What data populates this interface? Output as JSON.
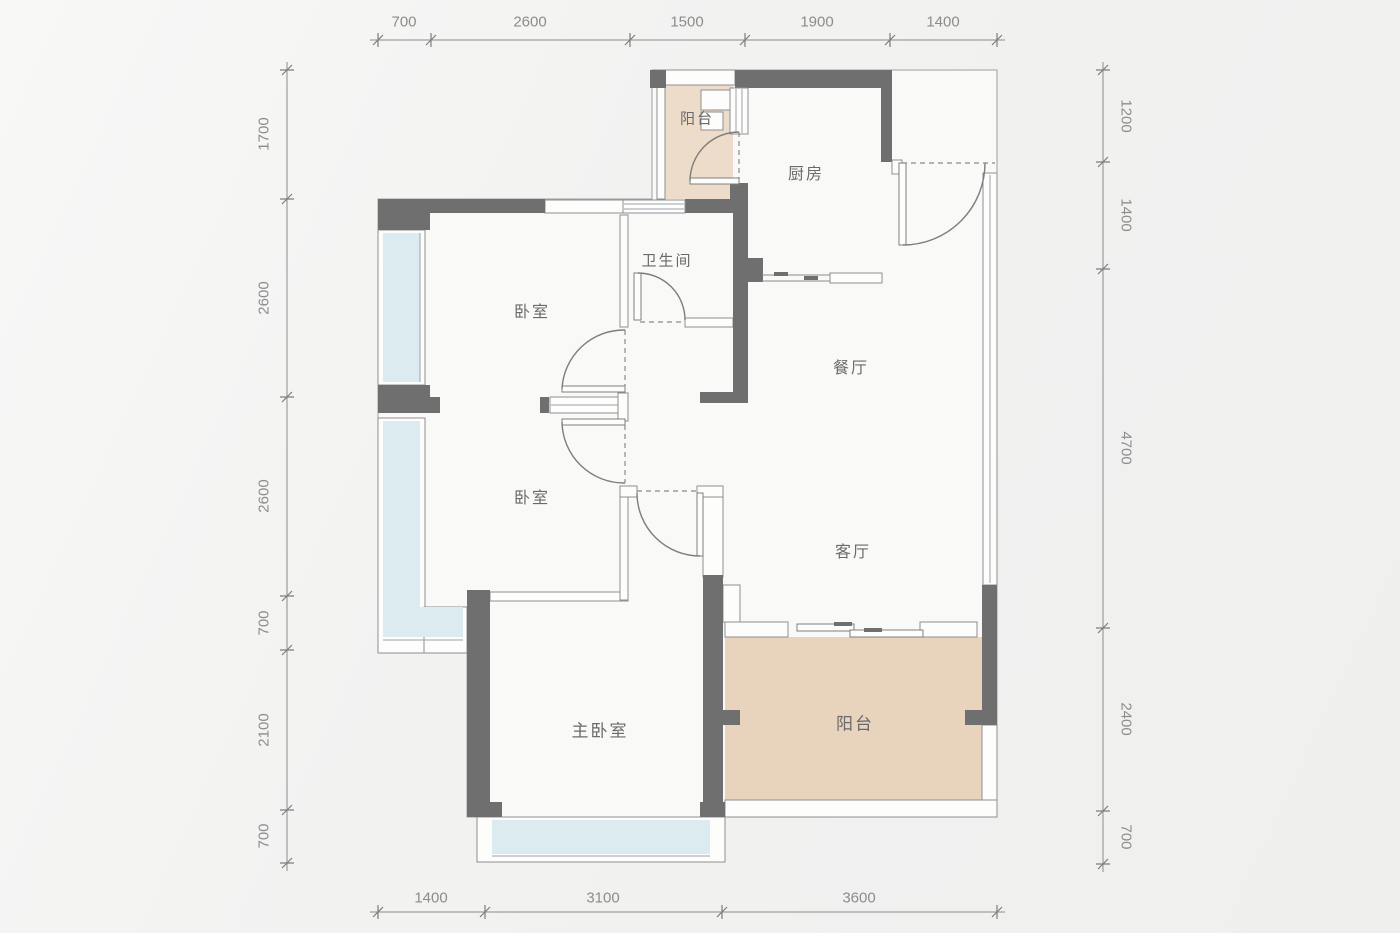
{
  "title": "apartment-floor-plan",
  "colors": {
    "wall": "#6f6f6f",
    "floor": "#f9f9f8",
    "glass": "#dcebf0",
    "balcony_top": "#eedcca",
    "balcony_bottom": "#e8d3bd",
    "text": "#6a6a6a",
    "dimtext": "#8c8c8c"
  },
  "rooms": [
    {
      "id": "balcony-top",
      "label": "阳台"
    },
    {
      "id": "kitchen",
      "label": "厨房"
    },
    {
      "id": "bathroom",
      "label": "卫生间"
    },
    {
      "id": "bedroom-1",
      "label": "卧室"
    },
    {
      "id": "dining-room",
      "label": "餐厅"
    },
    {
      "id": "bedroom-2",
      "label": "卧室"
    },
    {
      "id": "living-room",
      "label": "客厅"
    },
    {
      "id": "master-bedroom",
      "label": "主卧室"
    },
    {
      "id": "balcony-bottom",
      "label": "阳台"
    }
  ],
  "dimensions": {
    "top": [
      "700",
      "2600",
      "1500",
      "1900",
      "1400"
    ],
    "bottom": [
      "1400",
      "3100",
      "3600"
    ],
    "left": [
      "1700",
      "2600",
      "2600",
      "700",
      "2100",
      "700"
    ],
    "right": [
      "1200",
      "1400",
      "4700",
      "2400",
      "700"
    ]
  }
}
